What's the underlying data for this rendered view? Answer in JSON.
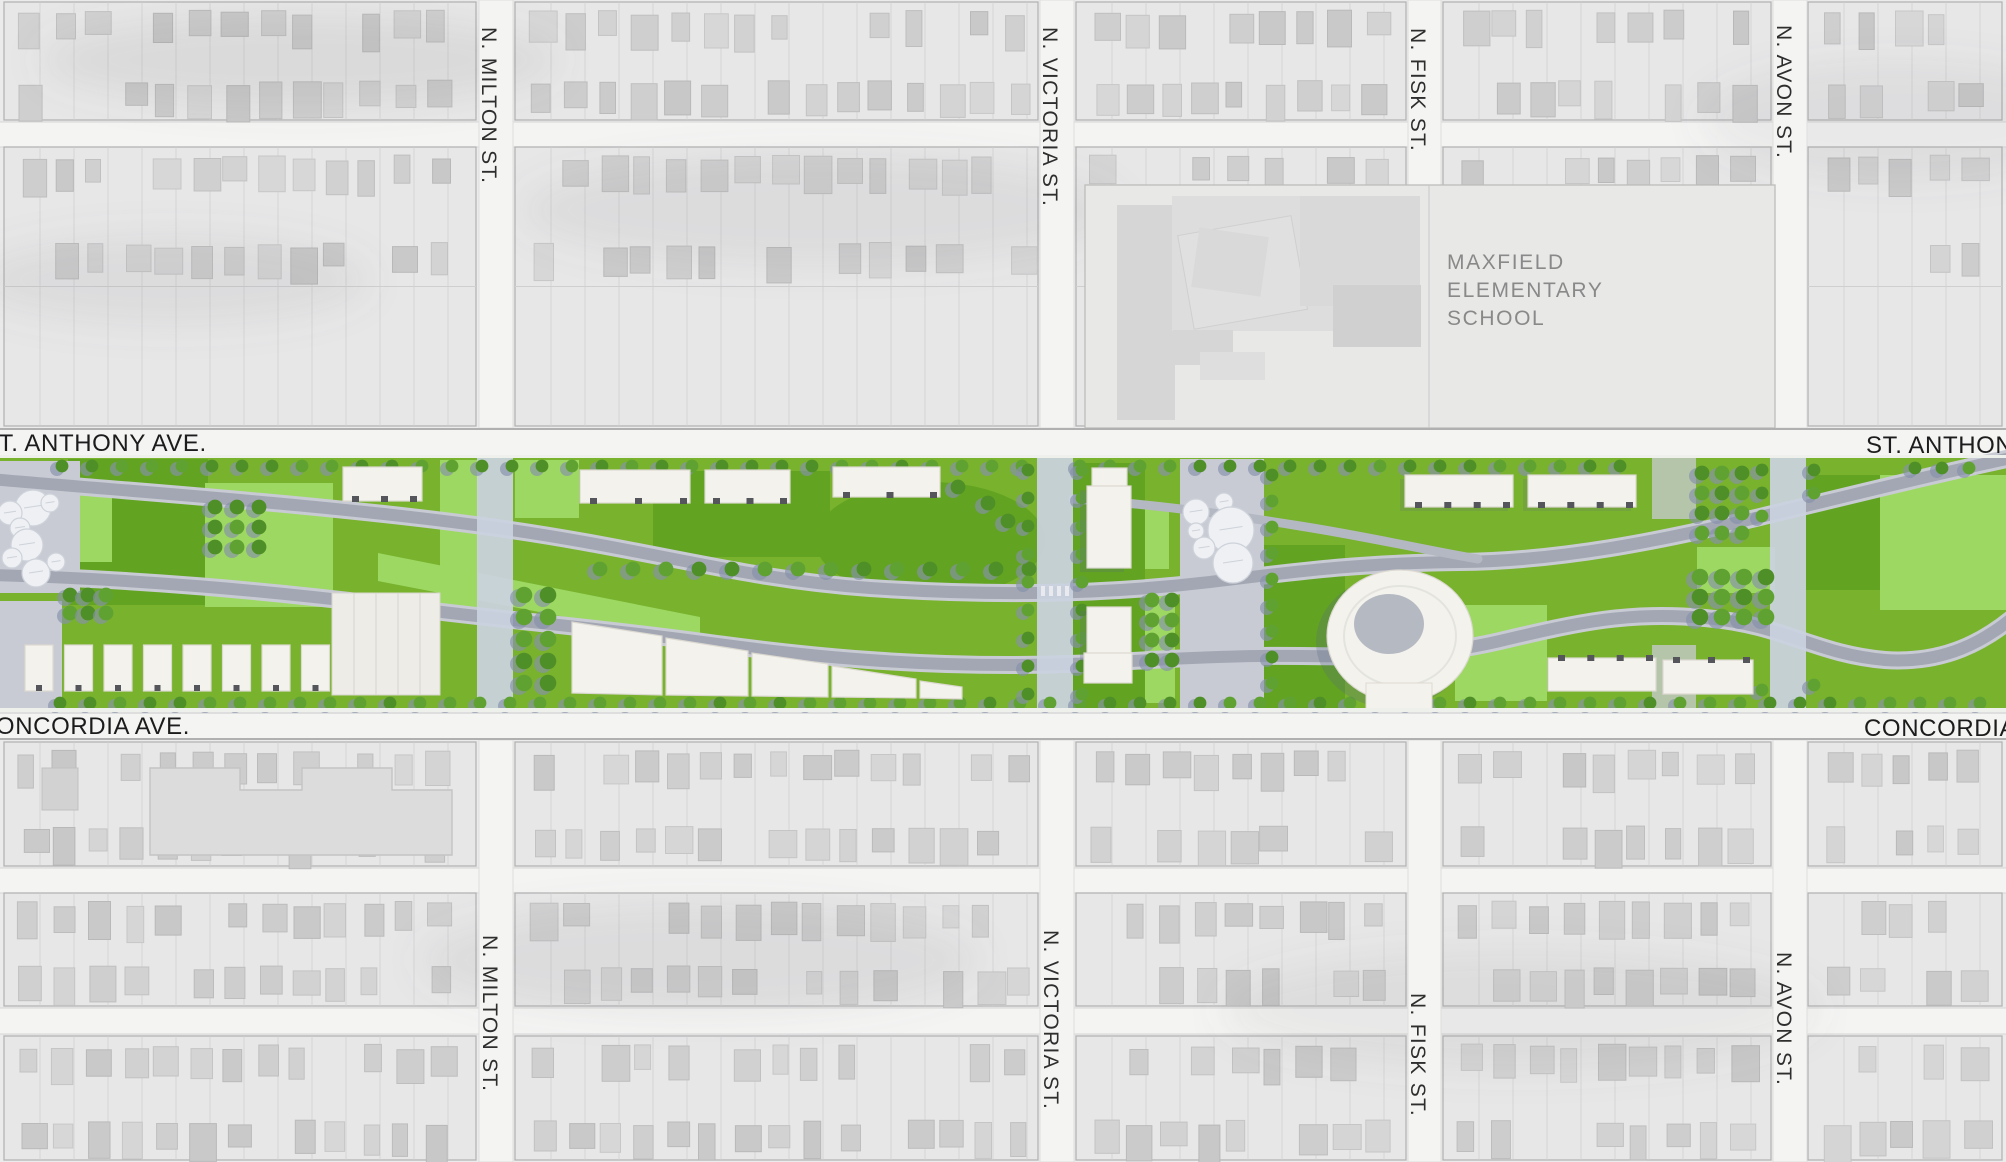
{
  "map": {
    "streets": {
      "milton": "N. MILTON ST.",
      "victoria": "N. VICTORIA ST.",
      "fisk": "N. FISK ST.",
      "avon": "N. AVON ST.",
      "st_anthony": "ST. ANTHONY AVE.",
      "concordia": "CONCORDIA AVE."
    },
    "school": {
      "lines": [
        "MAXFIELD",
        "ELEMENTARY",
        "SCHOOL"
      ]
    }
  },
  "colors": {
    "aerial_bg": "#ebebeb",
    "aerial_block": "#e7e7e7",
    "aerial_street": "#f4f4f3",
    "block_line": "#b4b4b4",
    "parcel_line": "#cfcfcf",
    "school_panel": "#e8e8e7",
    "school_bldg": "#d6d6d6",
    "school_bldg_light": "#e0e0e0",
    "apartment": "#dcdcdc",
    "apartment_stroke": "#c4c4c4",
    "label_street": "#2e2e2e",
    "label_avenue": "#1c1c1c",
    "label_school": "#898989",
    "lawn_base": "#79b22d",
    "lawn_light": "#9dd862",
    "lawn_dark": "#62a421",
    "tree": "#4f8f28",
    "tree_alt": "#5fa232",
    "tree_shadow": "#8591ab",
    "road_edge": "#c8cbd3",
    "road_fill": "#a2a7b3",
    "road_minor": "#b4b8c3",
    "crossing": "#cbd2df",
    "plaza": "#c8cbd4",
    "bldg_fill": "#f3f2ed",
    "bldg_stroke": "#dcd9d1",
    "bldg_tick": "#54565c",
    "bldg_shadow": "#5a6784",
    "donut_hole": "#b5b9c2",
    "circle_fill": "#eef0f3",
    "circle_stroke": "#ced2da",
    "frame": "#eef0ec"
  }
}
